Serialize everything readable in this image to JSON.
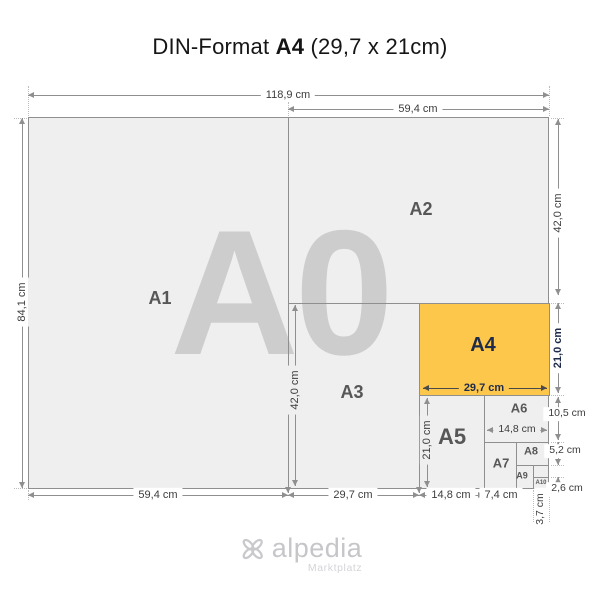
{
  "title": {
    "prefix": "DIN-Format ",
    "format": "A4",
    "suffix": " (29,7 x 21cm)"
  },
  "watermark": "A0",
  "formats": {
    "a1": "A1",
    "a2": "A2",
    "a3": "A3",
    "a4": "A4",
    "a5": "A5",
    "a6": "A6",
    "a7": "A7",
    "a8": "A8",
    "a9": "A9",
    "a10": "A10"
  },
  "dimensions": {
    "a0_width": "118,9 cm",
    "a2_width": "59,4 cm",
    "a0_height": "84,1 cm",
    "a2_height": "42,0 cm",
    "a4_height": "21,0 cm",
    "a6_height": "10,5 cm",
    "a8_height": "5,2 cm",
    "a10_height": "2,6 cm",
    "a1_width": "59,4 cm",
    "a3_width": "29,7 cm",
    "a5_width": "14,8 cm",
    "a7_width": "7,4 cm",
    "a10_width": "3,7 cm",
    "a3_height": "42,0 cm",
    "a4_width": "29,7 cm",
    "a5_height": "21,0 cm",
    "a6_width": "14,8 cm"
  },
  "logo": {
    "name": "alpedia",
    "subtitle": "Marktplatz"
  },
  "colors": {
    "highlight": "#fdc74c",
    "paper": "#efefef",
    "line": "#8f8f8f",
    "watermark": "#cdcdcd",
    "accent_text": "#1e2b4a"
  }
}
